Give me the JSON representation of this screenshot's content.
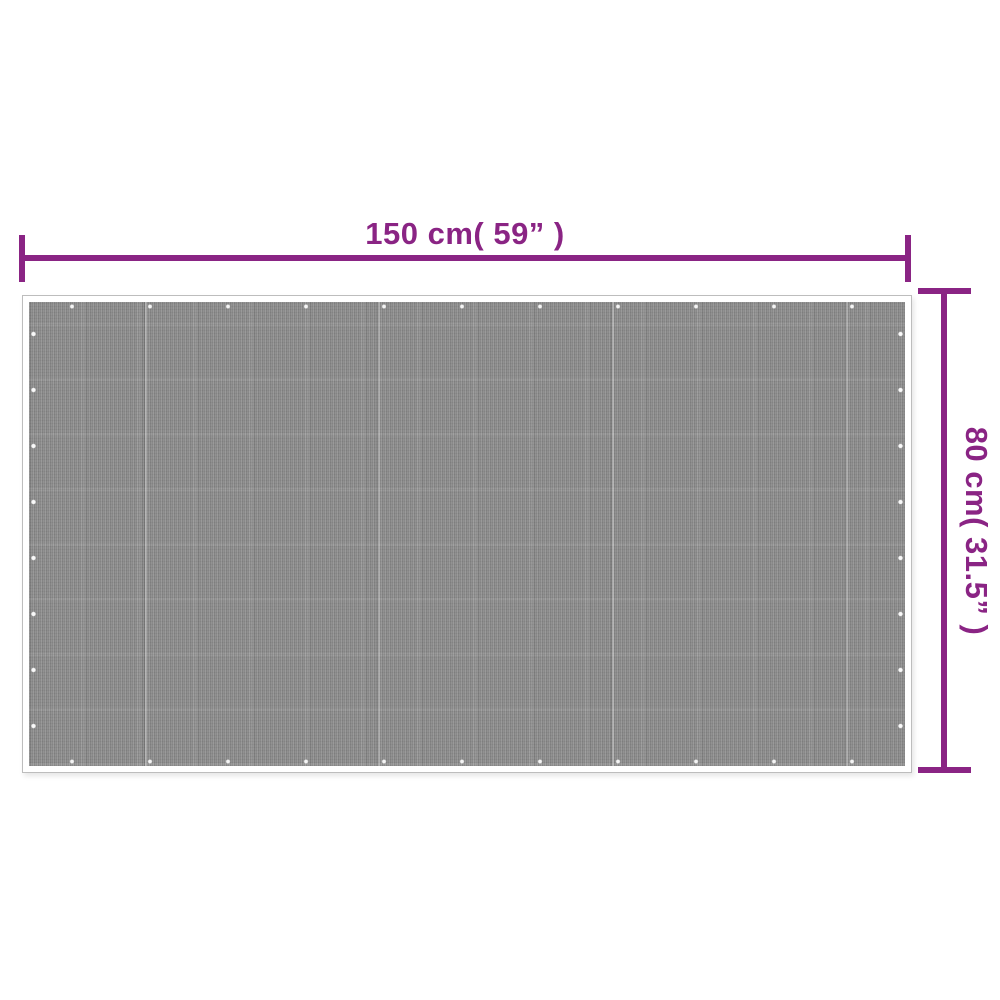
{
  "diagram": {
    "type": "product-dimension-diagram",
    "product": "woven outdoor mat",
    "width_label": "150 cm( 59” )",
    "height_label": "80 cm( 31.5” )",
    "accent_color": "#8a2484",
    "mat_color": "#8f8f8f",
    "mat_border_color": "#ffffff",
    "mat_outline_color": "#bdbdbd",
    "background_color": "#ffffff"
  }
}
